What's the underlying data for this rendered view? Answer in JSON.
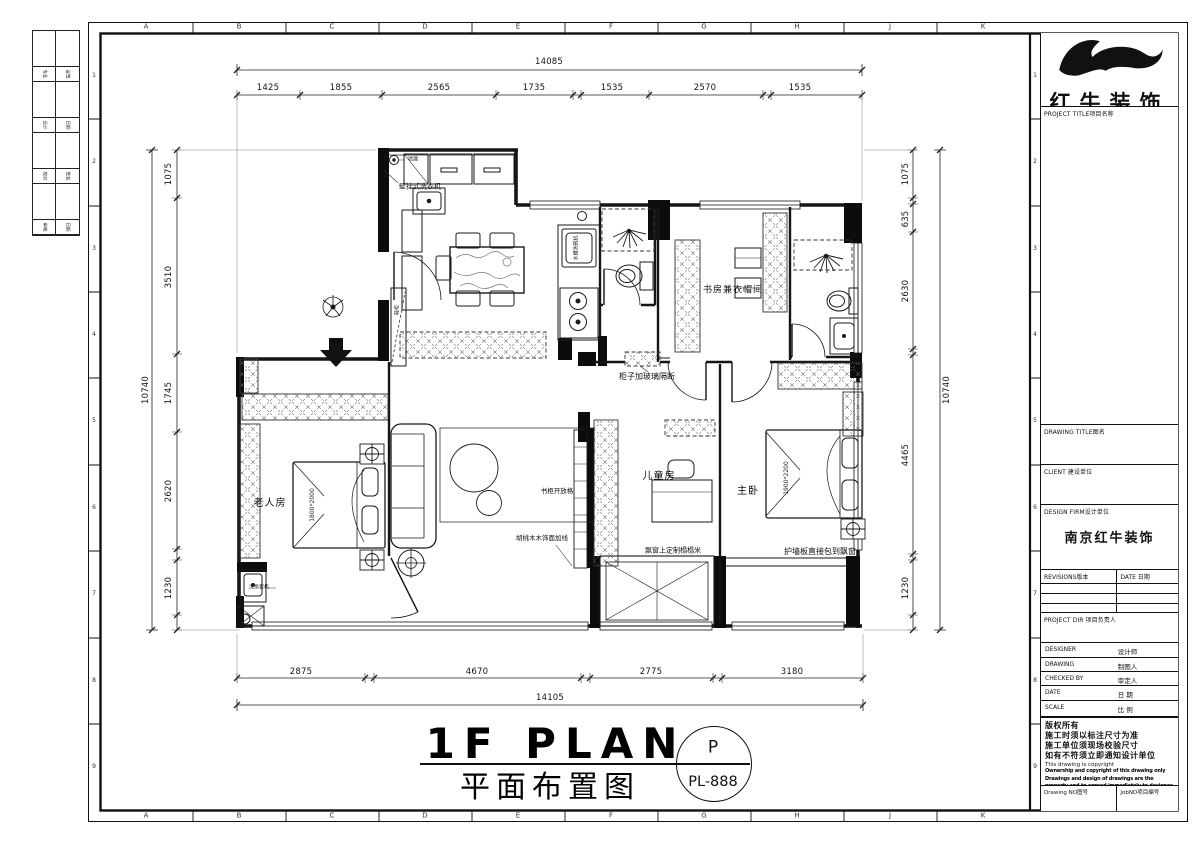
{
  "frame": {
    "letters": [
      "A",
      "B",
      "C",
      "D",
      "E",
      "F",
      "G",
      "H",
      "J",
      "K"
    ],
    "rows": [
      "1",
      "2",
      "3",
      "4",
      "5",
      "6",
      "7",
      "8",
      "9"
    ]
  },
  "sig": {
    "rows": [
      [
        "专业",
        "会签"
      ],
      [
        "设计",
        "日期"
      ],
      [
        "校对",
        "签名"
      ],
      [
        "审核",
        "日期"
      ]
    ]
  },
  "dims": {
    "top_overall": "14085",
    "top": [
      "1425",
      "1855",
      "2565",
      "1735",
      "1535",
      "2570",
      "1535"
    ],
    "left_overall": "10740",
    "left": [
      "1075",
      "3510",
      "1745",
      "2620",
      "1230"
    ],
    "right_overall": "10740",
    "right": [
      "1075",
      "635",
      "2630",
      "4465",
      "1230"
    ],
    "bottom": [
      "2875",
      "4670",
      "2775",
      "3180"
    ],
    "bottom_overall": "14105"
  },
  "rooms": {
    "elder": "老人房",
    "child": "儿童房",
    "master": "主卧",
    "study": "书房兼衣帽间"
  },
  "notes": {
    "washer": "壁挂式洗衣机",
    "drain": "地漏",
    "shoe": "鞋柜",
    "sink": "水槽洗碗机",
    "partition": "柜子加玻璃隔断",
    "bookshelf": "书柜开放格",
    "walnut": "胡桃木木饰面加线",
    "tatami": "飘窗上定制榻榻米",
    "wallpanel": "护墙板直接包到飘窗",
    "washerdryer": "洗烘套机",
    "bed_elder": "1800*2000",
    "bed_master": "1900*2200"
  },
  "titlebar": {
    "en": "1F PLAN",
    "cn": "平面布置图",
    "tag_top": "P",
    "tag_bottom": "PL-888"
  },
  "tb": {
    "company": "红牛装饰",
    "project": "PROJECT TITLE项目名称",
    "dtitle": "DRAWING TITLE图名",
    "client": "CLIENT 建设单位",
    "firm": "DESIGN FIRM设计单位",
    "firm_value": "南京红牛装饰",
    "revisions": "REVISIONS版本",
    "date_col": "DATE 日期",
    "pdir": "PROJECT DIR 项目负责人",
    "designer_en": "DESIGNER",
    "designer_cn": "设计师",
    "drawing_en": "DRAWING",
    "drawing_cn": "制图人",
    "checked_en": "CHECKED BY",
    "checked_cn": "审定人",
    "date_en": "DATE",
    "date_cn": "日 期",
    "scale_en": "SCALE",
    "scale_cn": "比 例",
    "copy1": "版权所有",
    "copy2": "施工时须以标注尺寸为准",
    "copy3": "施工单位须现场校验尺寸",
    "copy4": "如有不符须立即通知设计单位",
    "copy5": "This drawing is copyright",
    "copy6": "Ownership and copyright of this drawing only",
    "copy7": "Drawings and design of drawings are the",
    "copy8": "property and to agreed immediately to designer",
    "dno": "Drawing NO图号",
    "jno": "JobNO项目编号"
  }
}
